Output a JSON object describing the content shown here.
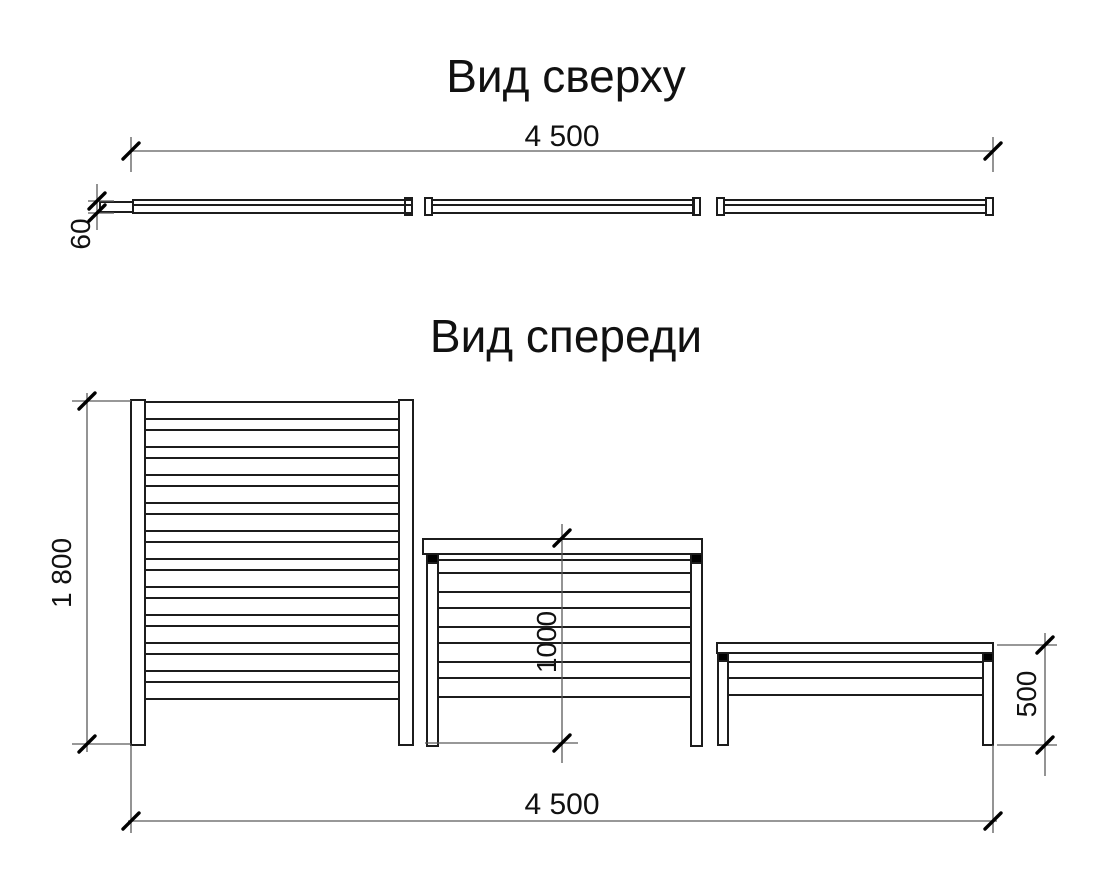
{
  "titles": {
    "top_view": "Вид сверху",
    "front_view": "Вид спереди"
  },
  "dimensions": {
    "top_width": "4 500",
    "top_thickness": "60",
    "panel1_height": "1 800",
    "panel2_height": "1000",
    "panel3_height": "500",
    "bottom_width": "4 500"
  },
  "colors": {
    "line": "#1c1c1c",
    "dim_line": "#5a5a5a",
    "tick": "#000000",
    "background": "#ffffff"
  },
  "drawing": {
    "rects": [
      {
        "g": "top",
        "n": "bar-left-block",
        "x": 100,
        "y": 202,
        "w": 33,
        "h": 10
      },
      {
        "g": "top",
        "n": "bar-segment",
        "x": 133,
        "y": 200,
        "w": 279,
        "h": 13
      },
      {
        "g": "top",
        "n": "bar-end-cap",
        "x": 405,
        "y": 198,
        "w": 7,
        "h": 17
      },
      {
        "g": "top",
        "n": "bar-end-cap",
        "x": 425,
        "y": 198,
        "w": 7,
        "h": 17
      },
      {
        "g": "top",
        "n": "bar-segment",
        "x": 432,
        "y": 200,
        "w": 262,
        "h": 13
      },
      {
        "g": "top",
        "n": "bar-end-cap",
        "x": 693,
        "y": 198,
        "w": 7,
        "h": 17
      },
      {
        "g": "top",
        "n": "bar-end-cap",
        "x": 717,
        "y": 198,
        "w": 7,
        "h": 17
      },
      {
        "g": "top",
        "n": "bar-segment",
        "x": 724,
        "y": 200,
        "w": 262,
        "h": 13
      },
      {
        "g": "top",
        "n": "bar-end-cap",
        "x": 986,
        "y": 198,
        "w": 7,
        "h": 17
      },
      {
        "g": "tall",
        "n": "post",
        "x": 131,
        "y": 400,
        "w": 14,
        "h": 345
      },
      {
        "g": "tall",
        "n": "post",
        "x": 399,
        "y": 400,
        "w": 14,
        "h": 345
      },
      {
        "g": "mid",
        "n": "cap-rail",
        "x": 423,
        "y": 539,
        "w": 279,
        "h": 15
      },
      {
        "g": "mid",
        "n": "post",
        "x": 427,
        "y": 554,
        "w": 11,
        "h": 192
      },
      {
        "g": "mid",
        "n": "post",
        "x": 691,
        "y": 554,
        "w": 11,
        "h": 192
      },
      {
        "g": "mid",
        "n": "post-bracket",
        "x": 427,
        "y": 554,
        "w": 11,
        "h": 9,
        "f": 1
      },
      {
        "g": "mid",
        "n": "post-bracket",
        "x": 691,
        "y": 554,
        "w": 11,
        "h": 9,
        "f": 1
      },
      {
        "g": "small",
        "n": "cap-rail",
        "x": 717,
        "y": 643,
        "w": 276,
        "h": 10
      },
      {
        "g": "small",
        "n": "post",
        "x": 718,
        "y": 653,
        "w": 10,
        "h": 92
      },
      {
        "g": "small",
        "n": "post",
        "x": 983,
        "y": 653,
        "w": 10,
        "h": 92
      },
      {
        "g": "small",
        "n": "post-bracket",
        "x": 718,
        "y": 653,
        "w": 10,
        "h": 8,
        "f": 1
      },
      {
        "g": "small",
        "n": "post-bracket",
        "x": 983,
        "y": 653,
        "w": 10,
        "h": 8,
        "f": 1
      }
    ],
    "lines": [
      {
        "g": "top",
        "n": "bar-inner-line",
        "x1": 133,
        "y1": 205,
        "x2": 412,
        "y2": 205
      },
      {
        "g": "top",
        "n": "bar-inner-line",
        "x1": 432,
        "y1": 205,
        "x2": 694,
        "y2": 205
      },
      {
        "g": "top",
        "n": "bar-inner-line",
        "x1": 724,
        "y1": 205,
        "x2": 986,
        "y2": 205
      },
      {
        "g": "dims",
        "n": "dim-line",
        "d": 1,
        "x1": 131,
        "y1": 151,
        "x2": 993,
        "y2": 151
      },
      {
        "g": "dims",
        "n": "extension-line",
        "d": 1,
        "x1": 131,
        "y1": 137,
        "x2": 131,
        "y2": 172
      },
      {
        "g": "dims",
        "n": "extension-line",
        "d": 1,
        "x1": 993,
        "y1": 137,
        "x2": 993,
        "y2": 172
      },
      {
        "g": "dims",
        "n": "extension-line",
        "d": 1,
        "x1": 88,
        "y1": 201,
        "x2": 114,
        "y2": 201
      },
      {
        "g": "dims",
        "n": "extension-line",
        "d": 1,
        "x1": 88,
        "y1": 213,
        "x2": 114,
        "y2": 213
      },
      {
        "g": "dims",
        "n": "dim-line",
        "d": 1,
        "x1": 97,
        "y1": 184,
        "x2": 97,
        "y2": 230
      },
      {
        "g": "dims",
        "n": "dim-line",
        "d": 1,
        "x1": 87,
        "y1": 393,
        "x2": 87,
        "y2": 752
      },
      {
        "g": "dims",
        "n": "extension-line",
        "d": 1,
        "x1": 72,
        "y1": 401,
        "x2": 131,
        "y2": 401
      },
      {
        "g": "dims",
        "n": "extension-line",
        "d": 1,
        "x1": 72,
        "y1": 744,
        "x2": 131,
        "y2": 744
      },
      {
        "g": "dims",
        "n": "dim-line",
        "d": 1,
        "x1": 562,
        "y1": 524,
        "x2": 562,
        "y2": 763
      },
      {
        "g": "dims",
        "n": "extension-line",
        "d": 1,
        "x1": 425,
        "y1": 743,
        "x2": 578,
        "y2": 743
      },
      {
        "g": "dims",
        "n": "dim-line",
        "d": 1,
        "x1": 1045,
        "y1": 633,
        "x2": 1045,
        "y2": 776
      },
      {
        "g": "dims",
        "n": "extension-line",
        "d": 1,
        "x1": 997,
        "y1": 645,
        "x2": 1057,
        "y2": 645
      },
      {
        "g": "dims",
        "n": "extension-line",
        "d": 1,
        "x1": 997,
        "y1": 745,
        "x2": 1057,
        "y2": 745
      },
      {
        "g": "dims",
        "n": "dim-line",
        "d": 1,
        "x1": 128,
        "y1": 821,
        "x2": 997,
        "y2": 821
      },
      {
        "g": "dims",
        "n": "extension-line",
        "d": 1,
        "x1": 131,
        "y1": 745,
        "x2": 131,
        "y2": 833
      },
      {
        "g": "dims",
        "n": "extension-line",
        "d": 1,
        "x1": 993,
        "y1": 745,
        "x2": 993,
        "y2": 833
      }
    ],
    "panels": [
      {
        "id": "tall",
        "slats": {
          "x1": 145,
          "x2": 399,
          "ys": [
            402,
            419,
            430,
            447,
            458,
            475,
            486,
            503,
            514,
            531,
            542,
            559,
            570,
            587,
            598,
            615,
            626,
            643,
            654,
            671,
            682,
            699
          ]
        }
      },
      {
        "id": "mid",
        "slats": {
          "x1": 438,
          "x2": 691,
          "ys": [
            560,
            573,
            592,
            608,
            627,
            643,
            662,
            678,
            697
          ]
        }
      },
      {
        "id": "small",
        "slats": {
          "x1": 728,
          "x2": 983,
          "ys": [
            662,
            678,
            695
          ]
        }
      }
    ],
    "ticks": [
      {
        "x": 131,
        "y": 151
      },
      {
        "x": 993,
        "y": 151
      },
      {
        "x": 97,
        "y": 201
      },
      {
        "x": 97,
        "y": 213
      },
      {
        "x": 87,
        "y": 401
      },
      {
        "x": 87,
        "y": 744
      },
      {
        "x": 562,
        "y": 538
      },
      {
        "x": 562,
        "y": 743
      },
      {
        "x": 1045,
        "y": 645
      },
      {
        "x": 1045,
        "y": 745
      },
      {
        "x": 131,
        "y": 821
      },
      {
        "x": 993,
        "y": 821
      }
    ]
  }
}
